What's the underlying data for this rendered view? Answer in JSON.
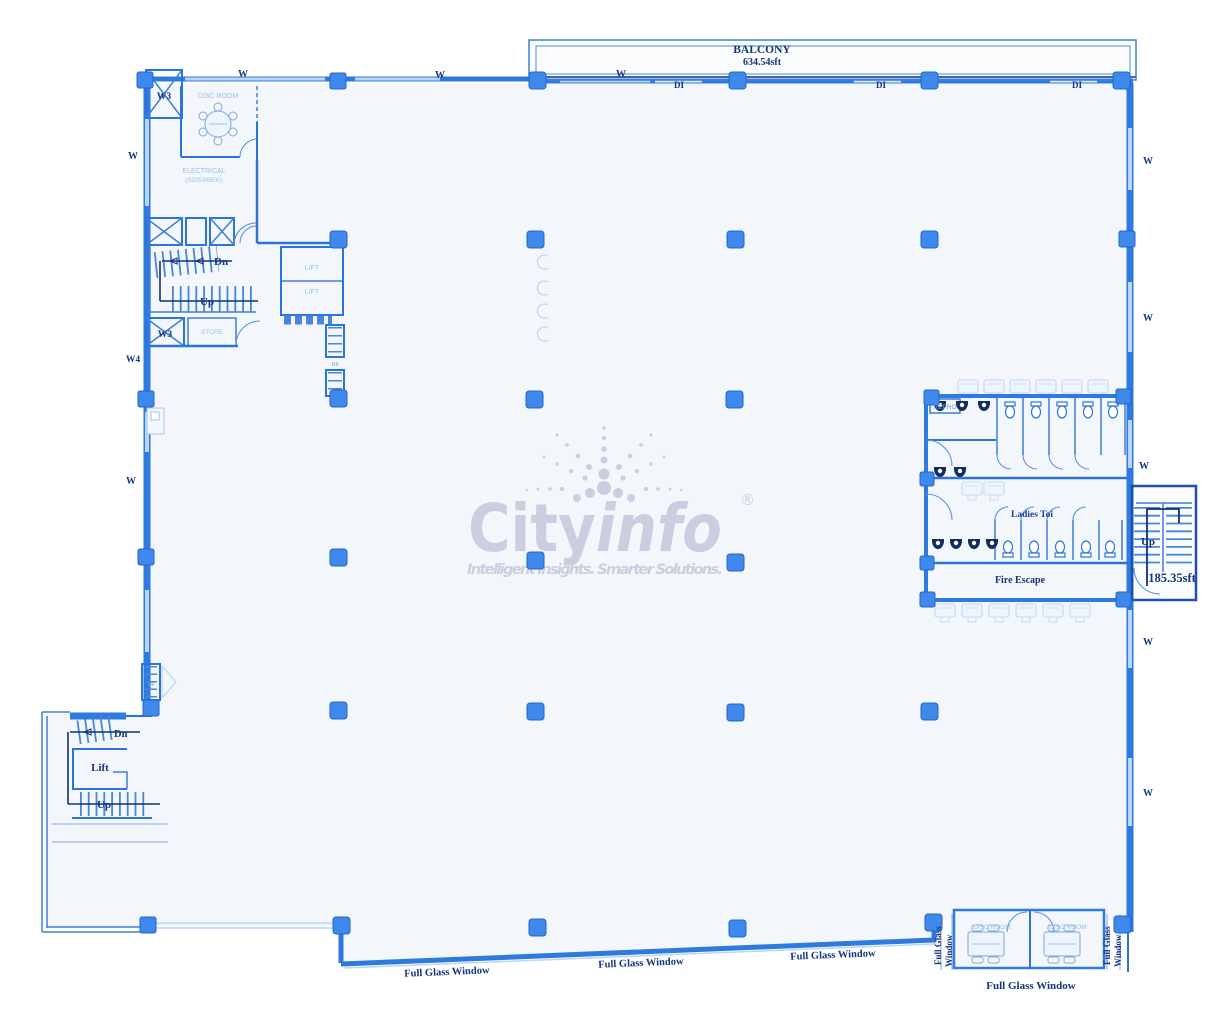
{
  "document": {
    "type": "floor-plan-blueprint"
  },
  "watermark": {
    "brand_city": "City",
    "brand_info": "info",
    "registered": "®",
    "tagline": "Intelligent Insights. Smarter Solutions.",
    "color": "#c9ccdf"
  },
  "balcony": {
    "label": "BALCONY",
    "area": "634.54sft"
  },
  "wall_labels": {
    "w": "W",
    "w3": "W3",
    "w4": "W4",
    "di": "DI",
    "d6": "D6"
  },
  "top_left_block": {
    "disc_room": "DISC ROOM",
    "electrical": "ELECTRICAL",
    "electrical_size": "(5325X6500)",
    "store": "STORE",
    "lift": "LIFT",
    "dn": "Dn",
    "up": "Up"
  },
  "toilets": {
    "repro": "REPRO",
    "ladies": "Ladies Toi",
    "fire_escape": "Fire Escape"
  },
  "right_stair": {
    "up": "Up",
    "area": "185.35sft"
  },
  "bottom_left_block": {
    "dn": "Dn",
    "lift": "Lift",
    "up": "Up"
  },
  "bottom_right": {
    "disc_room": "DISC ROOM"
  },
  "windows": {
    "full_glass_window": "Full Glass Window",
    "full_glass_line1": "Full Glass",
    "full_glass_line2": "Window"
  },
  "colors": {
    "wall_blue": "#2e7adf",
    "column_blue": "#3f88ec",
    "dark_label": "#14367e",
    "light_label": "#98bfed",
    "floor_fill": "#f3f7fc",
    "watermark_gray": "#c9ccdf"
  }
}
